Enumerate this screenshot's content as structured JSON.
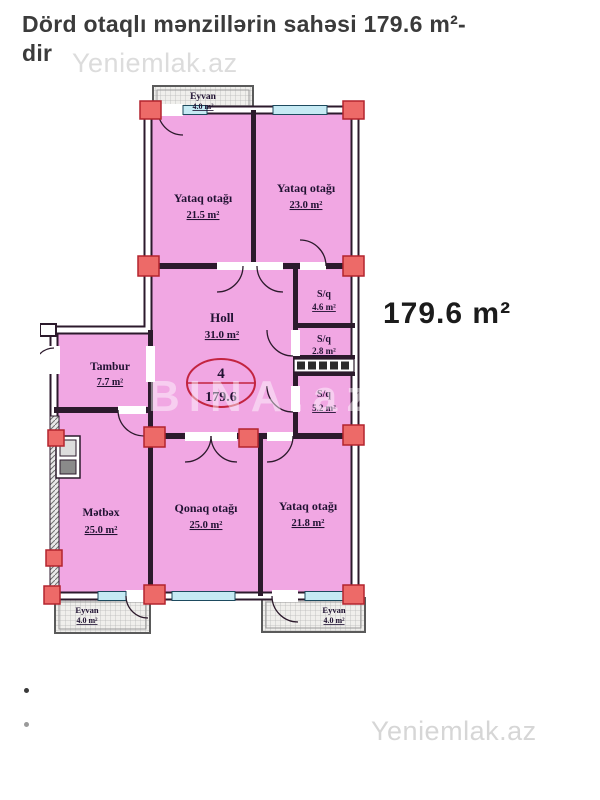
{
  "page": {
    "title_line1": "Dörd otaqlı mənzillərin sahəsi 179.6 m²-",
    "title_line2": "dir",
    "watermark_top": "Yeniemlak.az",
    "watermark_bottom": "Yeniemlak.az",
    "watermark_plan": "BINA.az",
    "area_callout": "179.6 m²"
  },
  "plan": {
    "stamp": {
      "rooms_count": "4",
      "total_area": "179.6"
    },
    "rooms": [
      {
        "id": "eyvan-top",
        "name": "Eyvan",
        "area": "4.0 m²"
      },
      {
        "id": "yataq-1",
        "name": "Yataq otağı",
        "area": "21.5 m²"
      },
      {
        "id": "yataq-2",
        "name": "Yataq otağı",
        "area": "23.0 m²"
      },
      {
        "id": "holl",
        "name": "Holl",
        "area": "31.0 m²"
      },
      {
        "id": "sq-1",
        "name": "S/q",
        "area": "4.6 m²"
      },
      {
        "id": "sq-2",
        "name": "S/q",
        "area": "2.8 m²"
      },
      {
        "id": "sq-3",
        "name": "S/q",
        "area": "5.2 m²"
      },
      {
        "id": "tambur",
        "name": "Tambur",
        "area": "7.7 m²"
      },
      {
        "id": "metbex",
        "name": "Mətbəx",
        "area": "25.0 m²"
      },
      {
        "id": "qonaq",
        "name": "Qonaq otağı",
        "area": "25.0 m²"
      },
      {
        "id": "yataq-3",
        "name": "Yataq otağı",
        "area": "21.8 m²"
      },
      {
        "id": "eyvan-bl",
        "name": "Eyvan",
        "area": "4.0 m²"
      },
      {
        "id": "eyvan-br",
        "name": "Eyvan",
        "area": "4.0 m²"
      }
    ],
    "colors": {
      "room_fill": "#f1a7e3",
      "wall": "#2c1a2c",
      "window": "#c6eaf4",
      "corner_block": "#ed6a68",
      "corner_block_border": "#b3242e",
      "stamp_red": "#c32440",
      "balcony_hatch": "#f0efec"
    }
  }
}
